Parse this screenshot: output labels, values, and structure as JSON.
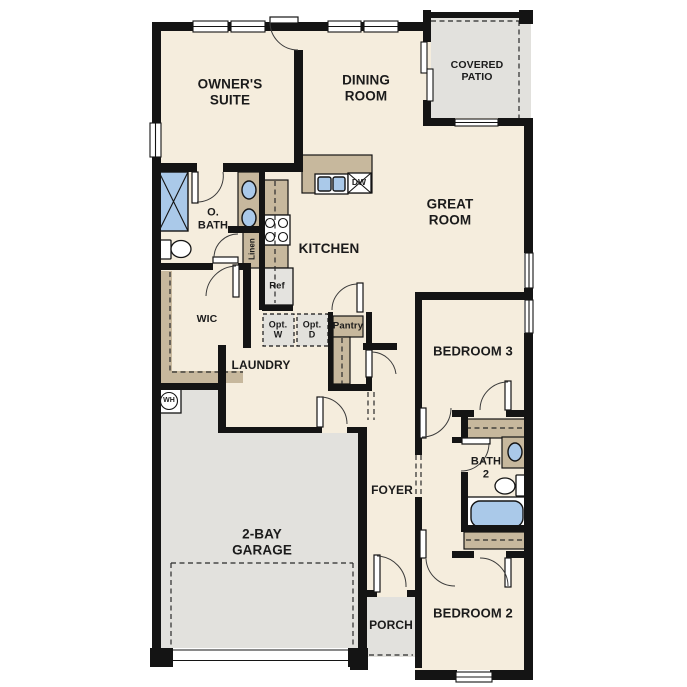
{
  "floor_plan": {
    "rooms": {
      "owners_suite": "OWNER'S\nSUITE",
      "dining_room": "DINING\nROOM",
      "covered_patio": "COVERED\nPATIO",
      "great_room": "GREAT\nROOM",
      "o_bath": "O.\nBATH",
      "kitchen": "KITCHEN",
      "wic": "WIC",
      "laundry": "LAUNDRY",
      "garage": "2-BAY\nGARAGE",
      "foyer": "FOYER",
      "porch": "PORCH",
      "bedroom_3": "BEDROOM 3",
      "bath_2": "BATH\n2",
      "bedroom_2": "BEDROOM 2"
    },
    "fixtures": {
      "refrigerator": "Ref",
      "dishwasher": "DW",
      "pantry": "Pantry",
      "linen": "Linen",
      "opt_washer": "Opt.\nW",
      "opt_dryer": "Opt.\nD",
      "water_heater": "WH"
    },
    "colors": {
      "wall": "#141414",
      "floor": "#f5eddd",
      "exterior": "#e2e1dd",
      "casework": "#c7b89d",
      "fixture": "#aac9e9",
      "label": "#1b1b1b"
    }
  }
}
